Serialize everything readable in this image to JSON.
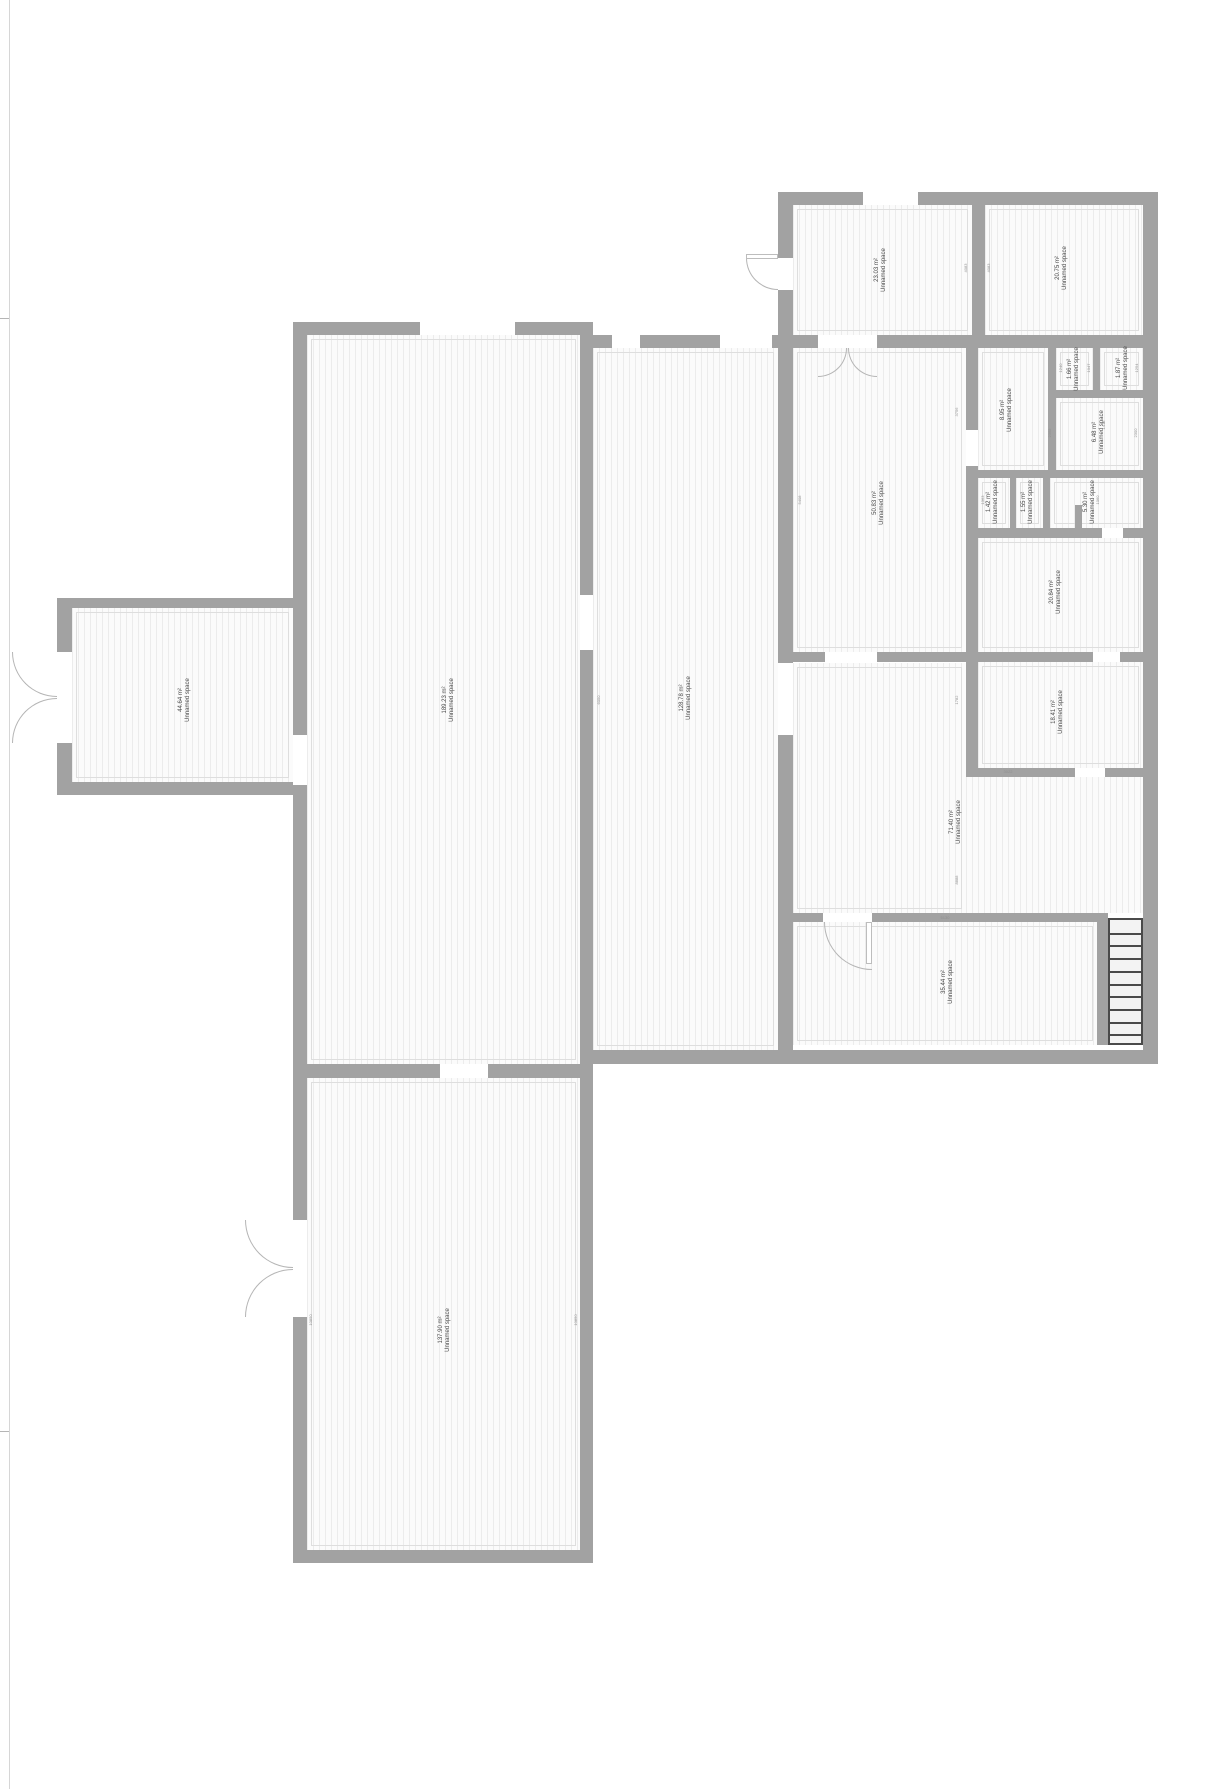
{
  "plan": {
    "width": 1206,
    "height": 1789,
    "wall_color": "#a2a2a2",
    "room_fill": "#fbfbfb",
    "hatch_color": "#ececec",
    "label_color": "#4a4a4a",
    "dim_color": "#909090"
  },
  "page_marks": {
    "left_border": {
      "x": 9,
      "y": 0,
      "h": 1789
    },
    "ticks": [
      {
        "x": 0,
        "y": 318,
        "w": 9
      },
      {
        "x": 0,
        "y": 1431,
        "w": 9
      }
    ]
  },
  "rooms": [
    {
      "id": "room-23-03",
      "name_label": "Unnamed space",
      "area_label": "23.03 m²",
      "x": 793,
      "y": 205,
      "w": 179,
      "h": 130,
      "lx": 881,
      "ly": 270
    },
    {
      "id": "room-20-75",
      "name_label": "Unnamed space",
      "area_label": "20.75 m²",
      "x": 985,
      "y": 205,
      "w": 158,
      "h": 130,
      "lx": 1062,
      "ly": 268
    },
    {
      "id": "room-50-83",
      "name_label": "Unnamed space",
      "area_label": "50.83 m²",
      "x": 793,
      "y": 348,
      "w": 173,
      "h": 304,
      "lx": 879,
      "ly": 503
    },
    {
      "id": "room-8-95",
      "name_label": "Unnamed space",
      "area_label": "8.95 m²",
      "x": 978,
      "y": 348,
      "w": 70,
      "h": 122,
      "lx": 1007,
      "ly": 410
    },
    {
      "id": "room-1-66",
      "name_label": "Unnamed space",
      "area_label": "1.66 m²",
      "x": 1056,
      "y": 348,
      "w": 37,
      "h": 42,
      "lx": 1074,
      "ly": 369
    },
    {
      "id": "room-1-87",
      "name_label": "Unnamed space",
      "area_label": "1.87 m²",
      "x": 1100,
      "y": 348,
      "w": 43,
      "h": 42,
      "lx": 1123,
      "ly": 368
    },
    {
      "id": "room-6-48",
      "name_label": "Unnamed space",
      "area_label": "6.48 m²",
      "x": 1056,
      "y": 398,
      "w": 87,
      "h": 72,
      "lx": 1099,
      "ly": 432
    },
    {
      "id": "room-1-42",
      "name_label": "Unnamed space",
      "area_label": "1.42 m²",
      "x": 978,
      "y": 478,
      "w": 32,
      "h": 50,
      "lx": 993,
      "ly": 502
    },
    {
      "id": "room-1-55",
      "name_label": "Unnamed space",
      "area_label": "1.55 m²",
      "x": 1016,
      "y": 478,
      "w": 27,
      "h": 50,
      "lx": 1028,
      "ly": 502
    },
    {
      "id": "room-5-30",
      "name_label": "Unnamed space",
      "area_label": "5.30 m²",
      "x": 1050,
      "y": 478,
      "w": 93,
      "h": 50,
      "lx": 1090,
      "ly": 502
    },
    {
      "id": "room-20-84",
      "name_label": "Unnamed space",
      "area_label": "20.84 m²",
      "x": 978,
      "y": 538,
      "w": 165,
      "h": 114,
      "lx": 1056,
      "ly": 592
    },
    {
      "id": "room-18-41",
      "name_label": "Unnamed space",
      "area_label": "18.41 m²",
      "x": 978,
      "y": 662,
      "w": 165,
      "h": 106,
      "lx": 1058,
      "ly": 712
    },
    {
      "id": "room-71-40",
      "name_label": "Unnamed space",
      "area_label": "71.40 m²",
      "x": 793,
      "y": 663,
      "w": 173,
      "h": 250,
      "lx": 956,
      "ly": 822
    },
    {
      "id": "room-35-44",
      "name_label": "Unnamed space",
      "area_label": "35.44 m²",
      "x": 793,
      "y": 922,
      "w": 304,
      "h": 123,
      "lx": 948,
      "ly": 982
    },
    {
      "id": "room-189-23",
      "name_label": "Unnamed space",
      "area_label": "189.23 m²",
      "x": 307,
      "y": 335,
      "w": 273,
      "h": 729,
      "lx": 449,
      "ly": 700
    },
    {
      "id": "room-128-78",
      "name_label": "Unnamed space",
      "area_label": "128.78 m²",
      "x": 593,
      "y": 348,
      "w": 185,
      "h": 702,
      "lx": 686,
      "ly": 698
    },
    {
      "id": "room-44-64",
      "name_label": "Unnamed space",
      "area_label": "44.64 m²",
      "x": 72,
      "y": 608,
      "w": 221,
      "h": 174,
      "lx": 185,
      "ly": 700
    },
    {
      "id": "room-137-90",
      "name_label": "Unnamed space",
      "area_label": "137.90 m²",
      "x": 307,
      "y": 1078,
      "w": 273,
      "h": 472,
      "lx": 445,
      "ly": 1330
    }
  ],
  "patches": [
    {
      "id": "room-71-40-extension",
      "x": 966,
      "y": 777,
      "w": 177,
      "h": 136
    }
  ],
  "walls": [
    {
      "x": 778,
      "y": 192,
      "w": 380,
      "h": 13
    },
    {
      "x": 778,
      "y": 192,
      "w": 15,
      "h": 872
    },
    {
      "x": 1143,
      "y": 192,
      "w": 15,
      "h": 872
    },
    {
      "x": 972,
      "y": 205,
      "w": 13,
      "h": 143
    },
    {
      "x": 778,
      "y": 335,
      "w": 380,
      "h": 13
    },
    {
      "x": 966,
      "y": 348,
      "w": 12,
      "h": 420
    },
    {
      "x": 1048,
      "y": 348,
      "w": 8,
      "h": 122
    },
    {
      "x": 1093,
      "y": 348,
      "w": 7,
      "h": 42
    },
    {
      "x": 1048,
      "y": 390,
      "w": 95,
      "h": 8
    },
    {
      "x": 966,
      "y": 470,
      "w": 177,
      "h": 8
    },
    {
      "x": 1010,
      "y": 478,
      "w": 6,
      "h": 50
    },
    {
      "x": 1043,
      "y": 478,
      "w": 7,
      "h": 50
    },
    {
      "x": 1075,
      "y": 505,
      "w": 7,
      "h": 23
    },
    {
      "x": 966,
      "y": 528,
      "w": 177,
      "h": 10
    },
    {
      "x": 793,
      "y": 652,
      "w": 350,
      "h": 10
    },
    {
      "x": 966,
      "y": 768,
      "w": 177,
      "h": 9
    },
    {
      "x": 793,
      "y": 913,
      "w": 315,
      "h": 9
    },
    {
      "x": 1097,
      "y": 913,
      "w": 11,
      "h": 132
    },
    {
      "x": 593,
      "y": 1050,
      "w": 565,
      "h": 14
    },
    {
      "x": 293,
      "y": 1064,
      "w": 300,
      "h": 14
    },
    {
      "x": 293,
      "y": 322,
      "w": 300,
      "h": 13
    },
    {
      "x": 580,
      "y": 335,
      "w": 212,
      "h": 13
    },
    {
      "x": 293,
      "y": 322,
      "w": 14,
      "h": 756
    },
    {
      "x": 580,
      "y": 322,
      "w": 13,
      "h": 742
    },
    {
      "x": 57,
      "y": 598,
      "w": 250,
      "h": 10
    },
    {
      "x": 57,
      "y": 598,
      "w": 15,
      "h": 194
    },
    {
      "x": 57,
      "y": 782,
      "w": 250,
      "h": 13
    },
    {
      "x": 293,
      "y": 1078,
      "w": 14,
      "h": 485
    },
    {
      "x": 580,
      "y": 1078,
      "w": 13,
      "h": 485
    },
    {
      "x": 293,
      "y": 1550,
      "w": 300,
      "h": 13
    }
  ],
  "openings": [
    {
      "x": 863,
      "y": 192,
      "w": 55,
      "h": 13
    },
    {
      "x": 778,
      "y": 258,
      "w": 15,
      "h": 32
    },
    {
      "x": 818,
      "y": 335,
      "w": 59,
      "h": 13
    },
    {
      "x": 420,
      "y": 322,
      "w": 95,
      "h": 13
    },
    {
      "x": 612,
      "y": 335,
      "w": 28,
      "h": 13
    },
    {
      "x": 720,
      "y": 335,
      "w": 52,
      "h": 13
    },
    {
      "x": 778,
      "y": 663,
      "w": 15,
      "h": 72
    },
    {
      "x": 825,
      "y": 652,
      "w": 52,
      "h": 10
    },
    {
      "x": 1093,
      "y": 652,
      "w": 27,
      "h": 10
    },
    {
      "x": 1102,
      "y": 528,
      "w": 21,
      "h": 10
    },
    {
      "x": 1075,
      "y": 768,
      "w": 30,
      "h": 9
    },
    {
      "x": 823,
      "y": 913,
      "w": 49,
      "h": 9
    },
    {
      "x": 440,
      "y": 1064,
      "w": 48,
      "h": 14
    },
    {
      "x": 580,
      "y": 595,
      "w": 13,
      "h": 55
    },
    {
      "x": 293,
      "y": 735,
      "w": 14,
      "h": 50
    },
    {
      "x": 57,
      "y": 652,
      "w": 15,
      "h": 91
    },
    {
      "x": 293,
      "y": 1220,
      "w": 14,
      "h": 97
    },
    {
      "x": 966,
      "y": 430,
      "w": 12,
      "h": 36
    }
  ],
  "doors": [
    {
      "x": 746,
      "y": 258,
      "s": 32,
      "corner": "bl"
    },
    {
      "x": 818,
      "y": 348,
      "s": 29,
      "corner": "br"
    },
    {
      "x": 848,
      "y": 348,
      "s": 29,
      "corner": "bl"
    },
    {
      "x": 824,
      "y": 922,
      "s": 48,
      "corner": "bl"
    },
    {
      "x": 12,
      "y": 652,
      "s": 45,
      "corner": "bl"
    },
    {
      "x": 12,
      "y": 698,
      "s": 45,
      "corner": "tl"
    },
    {
      "x": 245,
      "y": 1220,
      "s": 48,
      "corner": "bl"
    },
    {
      "x": 245,
      "y": 1269,
      "s": 48,
      "corner": "tl"
    }
  ],
  "door_leaves": [
    {
      "x": 746,
      "y": 254,
      "w": 32,
      "h": 5
    },
    {
      "x": 866,
      "y": 922,
      "w": 6,
      "h": 42
    }
  ],
  "stairs": {
    "x": 1108,
    "y": 918,
    "w": 35,
    "h": 127,
    "treads": 9
  },
  "dimensions": [
    {
      "t": "4083",
      "x": 966,
      "y": 268,
      "v": true
    },
    {
      "t": "4083",
      "x": 989,
      "y": 268,
      "v": true
    },
    {
      "t": "3756",
      "x": 957,
      "y": 412,
      "v": true
    },
    {
      "t": "5408",
      "x": 800,
      "y": 500,
      "v": true
    },
    {
      "t": "1240",
      "x": 1061,
      "y": 368,
      "v": true
    },
    {
      "t": "1047",
      "x": 1089,
      "y": 368,
      "v": true
    },
    {
      "t": "1254",
      "x": 1137,
      "y": 368,
      "v": true
    },
    {
      "t": "1413",
      "x": 1104,
      "y": 425,
      "v": true
    },
    {
      "t": "2300",
      "x": 1136,
      "y": 433,
      "v": true
    },
    {
      "t": "2368",
      "x": 1050,
      "y": 433,
      "v": true
    },
    {
      "t": "1363",
      "x": 983,
      "y": 500,
      "v": true
    },
    {
      "t": "1060",
      "x": 1098,
      "y": 500,
      "v": true
    },
    {
      "t": "1782",
      "x": 957,
      "y": 700,
      "v": true
    },
    {
      "t": "8888",
      "x": 957,
      "y": 880,
      "v": true
    },
    {
      "t": "6050",
      "x": 599,
      "y": 700,
      "v": true
    },
    {
      "t": "10850",
      "x": 311,
      "y": 1320,
      "v": true
    },
    {
      "t": "10850",
      "x": 576,
      "y": 1320,
      "v": true
    },
    {
      "t": "5130",
      "x": 945,
      "y": 918,
      "v": false
    },
    {
      "t": "3022",
      "x": 1008,
      "y": 772,
      "v": false
    }
  ]
}
